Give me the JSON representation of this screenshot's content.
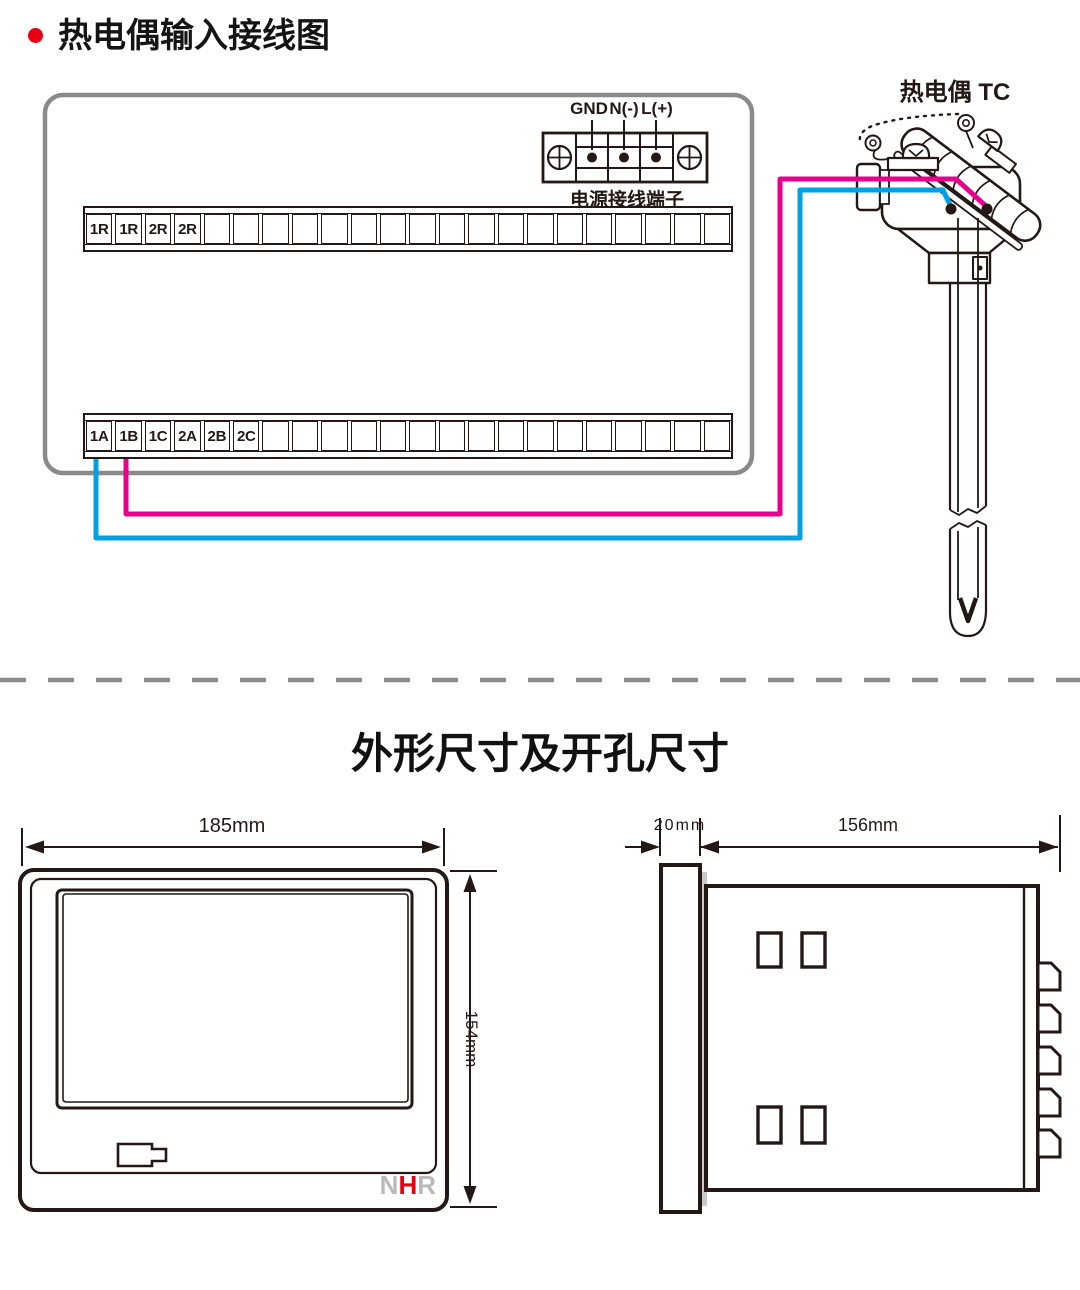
{
  "title": {
    "text": "热电偶输入接线图",
    "bullet_color": "#e60012"
  },
  "wiring": {
    "power_terminal": {
      "labels": [
        "GND",
        "N(-)",
        "L(+)"
      ],
      "caption": "电源接线端子"
    },
    "top_strip": {
      "labels": [
        "1R",
        "1R",
        "2R",
        "2R"
      ],
      "total_cells": 22
    },
    "bottom_strip": {
      "labels": [
        "1A",
        "1B",
        "1C",
        "2A",
        "2B",
        "2C"
      ],
      "total_cells": 22
    },
    "sensor": {
      "label": "热电偶 TC"
    },
    "colors": {
      "wire_positive": "#e8008c",
      "wire_negative": "#00a0e5",
      "panel_outline": "#8a8a8a",
      "ink": "#231815"
    }
  },
  "dimensions_section": {
    "title": "外形尺寸及开孔尺寸",
    "front_view": {
      "width_label": "185mm",
      "height_label": "154mm"
    },
    "side_view": {
      "bezel_depth_label": "20mm",
      "body_depth_label": "156mm"
    },
    "logo": {
      "letters": [
        "N",
        "H",
        "R"
      ],
      "letter_colors": [
        "#b9babc",
        "#e60012",
        "#b9babc"
      ]
    }
  }
}
